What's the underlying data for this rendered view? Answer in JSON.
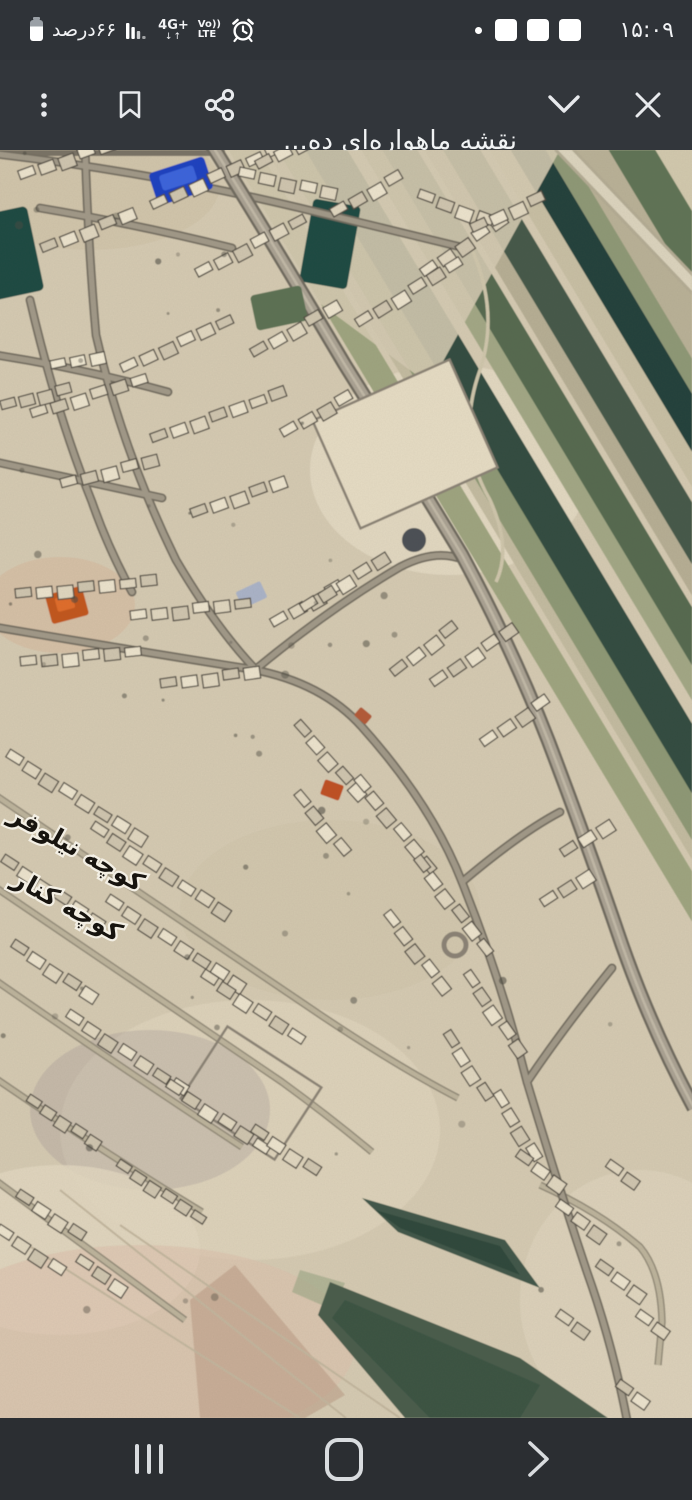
{
  "status_bar": {
    "time": "۱۵:۰۹",
    "battery_label": "۶۶درصد",
    "network_type": "4G+",
    "network_arrows": "↓↑",
    "volte_top": "Vo))",
    "volte_bottom": "LTE",
    "notification_icon_count": 3
  },
  "header": {
    "title": "نقشه ماهواره‌ای ده...",
    "url": "topomap.ir"
  },
  "map": {
    "type": "satellite-imagery",
    "street_labels": [
      {
        "text": "کوچه نیلوفر"
      },
      {
        "text": "کوچه کنار"
      }
    ]
  },
  "icons": {
    "status": [
      "battery-icon",
      "signal-bars-icon",
      "alarm-clock-icon",
      "notification-square-icon"
    ],
    "header": [
      "overflow-menu-icon",
      "bookmark-icon",
      "share-icon",
      "chevron-down-icon",
      "close-icon"
    ],
    "nav": [
      "recents-icon",
      "home-icon",
      "back-icon"
    ]
  },
  "colors": {
    "status_bar_bg": "#2f3338",
    "header_bg": "#32363b",
    "nav_bar_bg": "#2b2e32",
    "icon": "#e8eaed",
    "map_base": "#d5cab2",
    "field_dark_green": "#314c41",
    "pool_blue": "#1c40c0",
    "road_gray": "#a19988"
  }
}
